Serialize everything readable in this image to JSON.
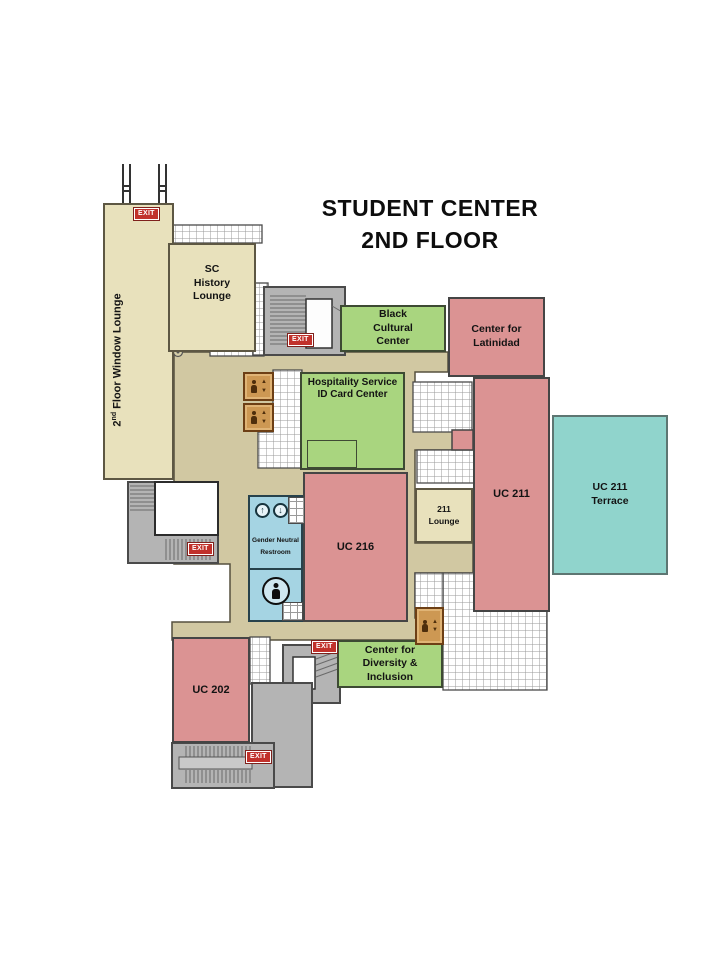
{
  "title": {
    "line1": "STUDENT CENTER",
    "line2": "2ND FLOOR"
  },
  "rooms": {
    "window_lounge": {
      "label_base": "2",
      "label_sup": "nd",
      "label_rest": " Floor Window Lounge"
    },
    "sc_history_lounge": {
      "label": "SC History Lounge"
    },
    "black_cultural_center": {
      "label": "Black Cultural Center"
    },
    "center_for_latinidad": {
      "label": "Center for Latinidad"
    },
    "hospitality_service_id": {
      "label": "Hospitality Service ID Card Center"
    },
    "uc_211": {
      "label": "UC 211"
    },
    "uc_211_terrace": {
      "label": "UC 211 Terrace"
    },
    "lounge_211": {
      "label": "211 Lounge"
    },
    "uc_216": {
      "label": "UC 216"
    },
    "gender_neutral_restroom": {
      "label": "Gender Neutral Restroom"
    },
    "center_for_diversity": {
      "label": "Center for Diversity & Inclusion"
    },
    "uc_202": {
      "label": "UC 202"
    }
  },
  "signs": {
    "exit": "EXIT"
  },
  "icons": {
    "elevator": "person with up/down arrows",
    "restroom_person": "person silhouette in circle",
    "up_arrow": "↑",
    "down_arrow": "↓"
  },
  "colors": {
    "room_pink": "#db9393",
    "room_green": "#a9d57f",
    "room_blue": "#a5d4e3",
    "terrace_teal": "#90d4cc",
    "lounge_tan": "#e8e1bc",
    "corridor_tan": "#d1c8a2",
    "stairwell_gray": "#b4b4b4",
    "elevator_brown": "#cd9853",
    "exit_red": "#c1312b"
  }
}
